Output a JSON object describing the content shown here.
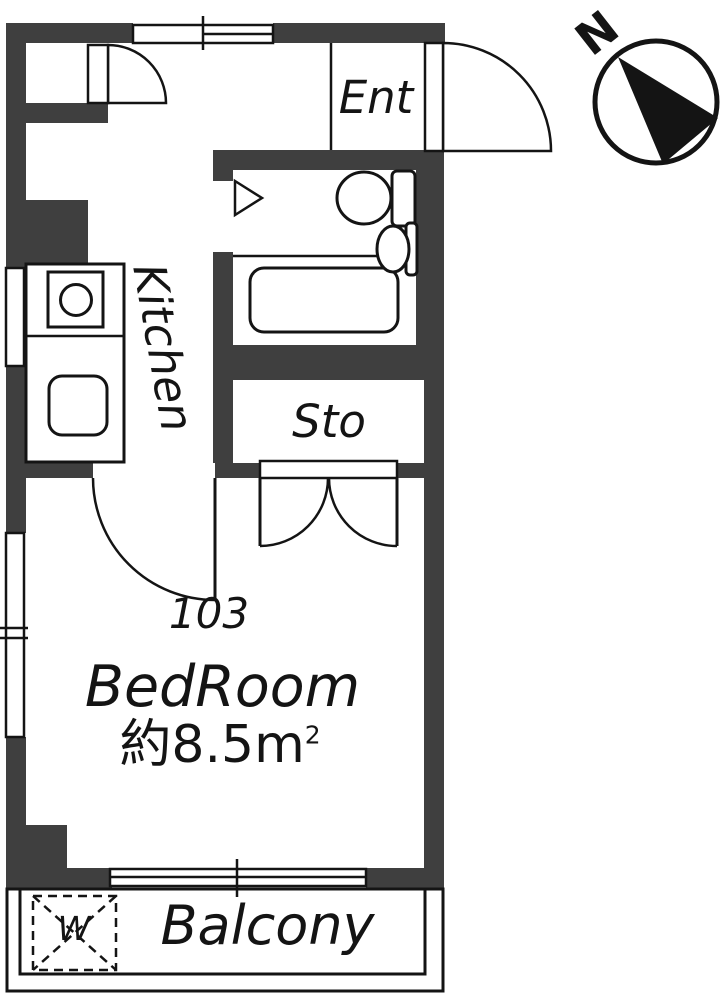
{
  "title": "Floor plan unit 103",
  "colors": {
    "wall": "#3f3f3f",
    "line": "#141414",
    "bg": "#ffffff"
  },
  "labels": {
    "entrance": "Ent",
    "kitchen": "Kitchen",
    "storage": "Sto",
    "room_number": "103",
    "bedroom": "BedRoom",
    "bedroom_area": "約8.5m",
    "bedroom_area_sup": "2",
    "balcony": "Balcony",
    "washer": "W",
    "compass_north": "N"
  }
}
